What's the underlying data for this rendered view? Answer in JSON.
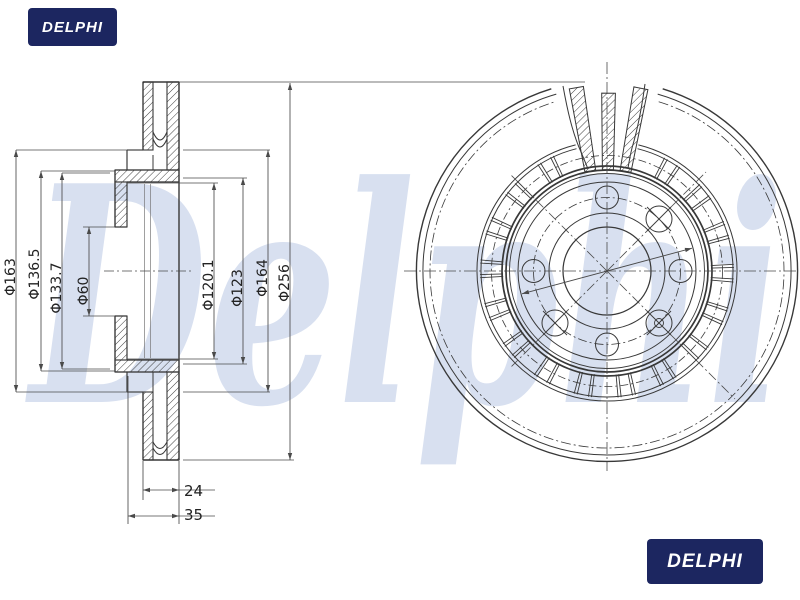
{
  "watermark": {
    "text": "Delphi"
  },
  "logos": {
    "top_left": "DELPHI",
    "bottom_right": "DELPHI"
  },
  "section_view": {
    "diameter_labels": [
      "Φ163",
      "Φ136.5",
      "Φ133.7",
      "Φ60",
      "Φ120.1",
      "Φ123",
      "Φ164",
      "Φ256"
    ],
    "thickness_label": "24",
    "height_label": "35"
  },
  "colors": {
    "line": "#383838",
    "dim_line": "#4a4a4a",
    "watermark": "#d8e0f0",
    "logo_bg": "#1c2660",
    "logo_fg": "#ffffff"
  }
}
